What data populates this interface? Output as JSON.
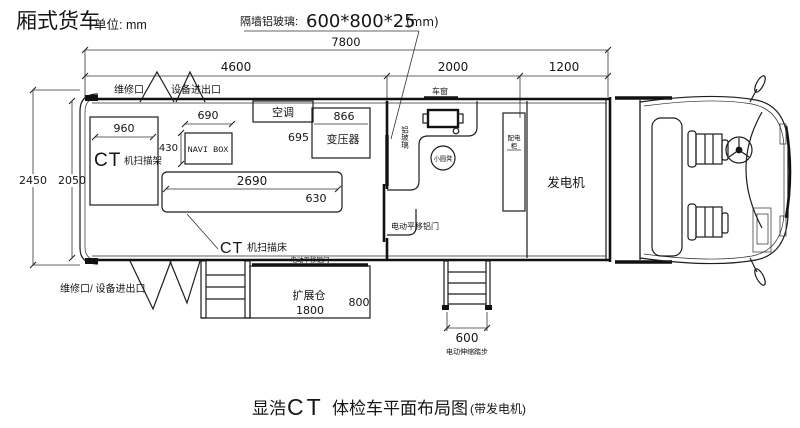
{
  "header": {
    "vehicle_type": "厢式货车",
    "unit": "单位: mm",
    "glass_note": {
      "label": "隔墙铝玻璃:",
      "size": "600*800*25",
      "unit": "(mm)"
    }
  },
  "dims": {
    "total": "7800",
    "seg1": "4600",
    "seg2": "2000",
    "seg3": "1200",
    "outer_h": "2450",
    "inner_h": "2050",
    "gantry_w": "960",
    "navi_w": "690",
    "navi_h": "430",
    "transformer_w": "866",
    "transformer_h": "695",
    "bed_l": "2690",
    "bed_w": "630",
    "bay_l": "1800",
    "bay_d": "800",
    "steps_w": "600"
  },
  "ct_room": {
    "gantry_ct": "CT",
    "gantry_label": "机扫描架",
    "navi_box": "NAVI BOX",
    "ac": "空调",
    "transformer": "变压器",
    "bed_ct": "CT",
    "bed_label": "机扫描床"
  },
  "hatches": {
    "top_left": "维修口",
    "top_right": "设备进出口",
    "bottom": "维修口/ 设备进出口"
  },
  "control_room": {
    "window": "车窗",
    "stool": "小圆凳",
    "glass_panel": "铝玻璃",
    "partition_door": "电动平移铝门",
    "cabinet_line1": "配电",
    "cabinet_line2": "柜"
  },
  "generator_room": {
    "label": "发电机"
  },
  "expansion_bay": {
    "label": "扩展仓",
    "door": "电动平移铝门"
  },
  "steps": {
    "label": "电动伸缩踏步"
  },
  "title": {
    "pre": "显浩",
    "ct": "CT",
    "main": "体检车平面布局图",
    "suffix": "(带发电机)"
  }
}
